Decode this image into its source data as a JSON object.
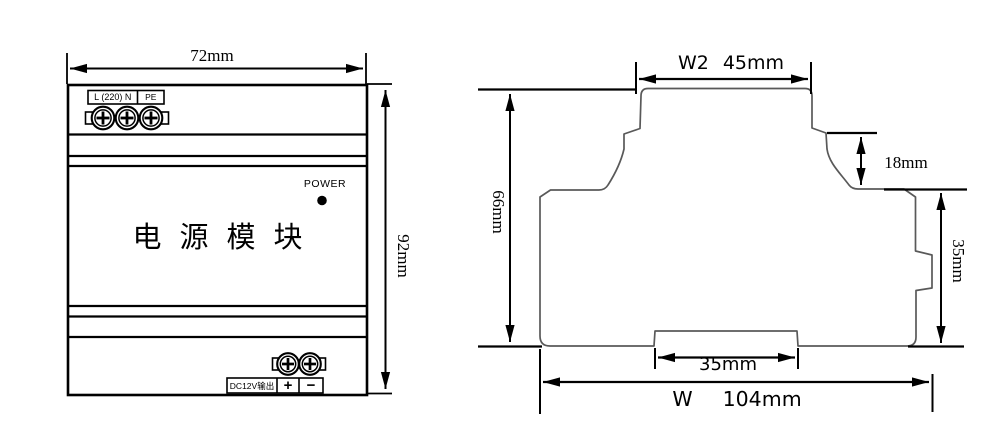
{
  "colors": {
    "dimension_line": "#000000",
    "profile_line": "#595959",
    "background": "#ffffff"
  },
  "front_view": {
    "width_dim": "72mm",
    "height_dim": "92mm",
    "terminal_label": "L (220) N",
    "terminal_label_pe": "PE",
    "power_led_label": "POWER",
    "product_name": "电源模块",
    "output_label": "DC12V输出",
    "output_plus": "+",
    "output_minus": "−"
  },
  "side_view": {
    "top_width_prefix": "W2",
    "top_width_value": "45mm",
    "height_dim": "66mm",
    "step_dim": "18mm",
    "rail_height_dim": "35mm",
    "bottom_slot_dim": "35mm",
    "total_width_prefix": "W",
    "total_width_value": "104mm"
  }
}
